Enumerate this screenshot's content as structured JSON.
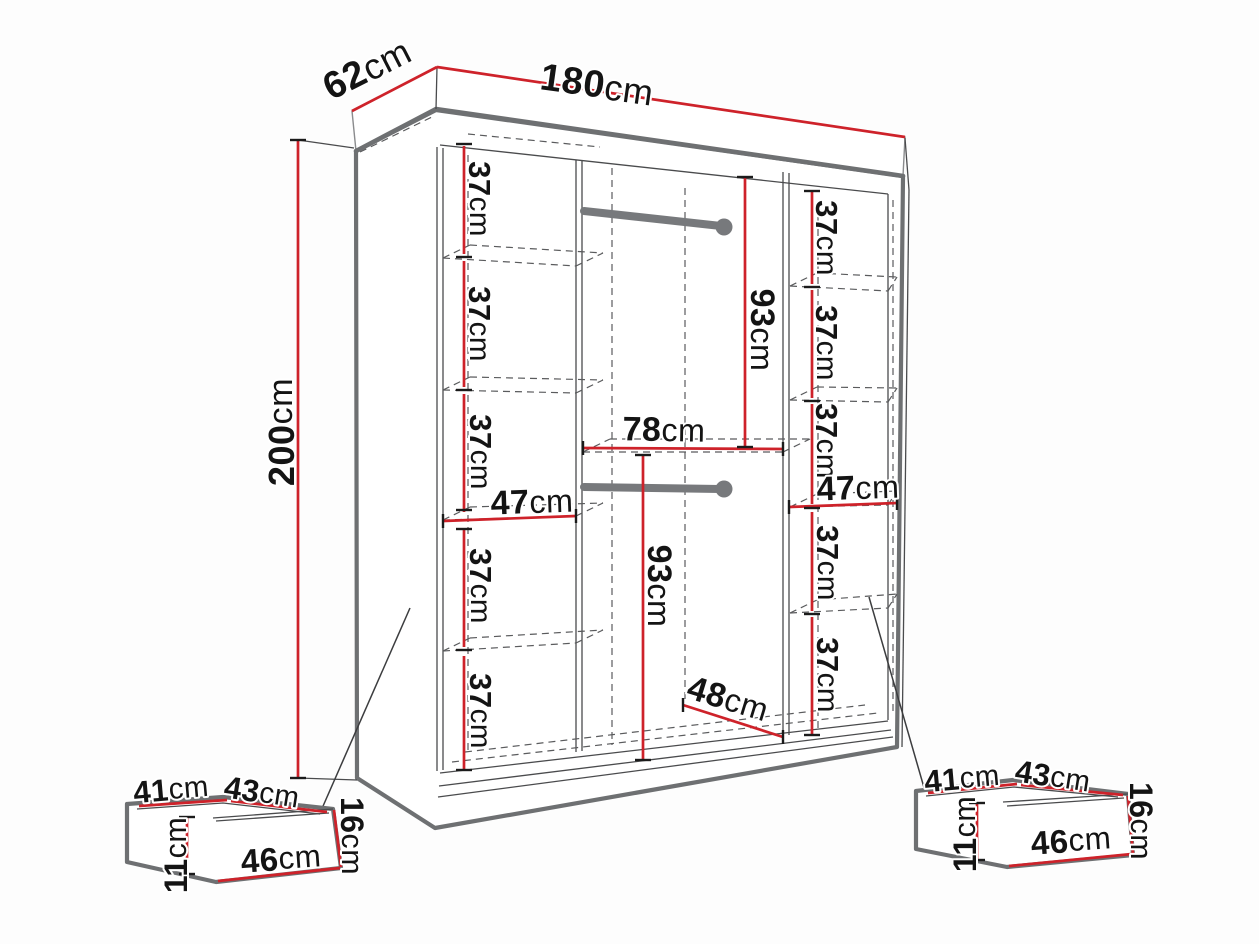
{
  "diagram": {
    "type": "furniture-dimension-diagram",
    "subject": "wardrobe-with-shelves-rails-and-two-drawers",
    "unit": "cm",
    "overall": {
      "width": "180",
      "depth": "62",
      "height": "200"
    },
    "colors": {
      "dimension_red": "#ce222a",
      "outline_gray": "#6e7072",
      "line_dark": "#3c3d3f",
      "dash_gray": "#5a5b5d",
      "rail_gray": "#77797c",
      "text": "#141414",
      "background": "#fdfdfd"
    },
    "labels": [
      {
        "id": "depth-62",
        "value": "62",
        "unit": "cm",
        "x": 367,
        "y": 69,
        "rot": -27,
        "size": 38
      },
      {
        "id": "width-180",
        "value": "180",
        "unit": "cm",
        "x": 597,
        "y": 85,
        "rot": 8,
        "size": 38
      },
      {
        "id": "height-200",
        "value": "200",
        "unit": "cm",
        "x": 281,
        "y": 432,
        "rot": -90,
        "size": 36
      },
      {
        "id": "shelf-37-left-1",
        "value": "37",
        "unit": "cm",
        "x": 480,
        "y": 199,
        "rot": 90,
        "size": 31
      },
      {
        "id": "shelf-37-left-2",
        "value": "37",
        "unit": "cm",
        "x": 480,
        "y": 324,
        "rot": 90,
        "size": 31
      },
      {
        "id": "shelf-37-left-3",
        "value": "37",
        "unit": "cm",
        "x": 481,
        "y": 452,
        "rot": 90,
        "size": 31
      },
      {
        "id": "shelf-37-left-4",
        "value": "37",
        "unit": "cm",
        "x": 481,
        "y": 586,
        "rot": 90,
        "size": 31
      },
      {
        "id": "shelf-37-left-5",
        "value": "37",
        "unit": "cm",
        "x": 481,
        "y": 711,
        "rot": 90,
        "size": 31
      },
      {
        "id": "width-47-left",
        "value": "47",
        "unit": "cm",
        "x": 532,
        "y": 502,
        "rot": -2,
        "size": 34
      },
      {
        "id": "height-93-top",
        "value": "93",
        "unit": "cm",
        "x": 762,
        "y": 330,
        "rot": 90,
        "size": 34
      },
      {
        "id": "width-78",
        "value": "78",
        "unit": "cm",
        "x": 664,
        "y": 430,
        "rot": 1,
        "size": 34
      },
      {
        "id": "height-93-bottom",
        "value": "93",
        "unit": "cm",
        "x": 659,
        "y": 586,
        "rot": 90,
        "size": 34
      },
      {
        "id": "width-48",
        "value": "48",
        "unit": "cm",
        "x": 728,
        "y": 699,
        "rot": 17,
        "size": 34
      },
      {
        "id": "shelf-37-right-1",
        "value": "37",
        "unit": "cm",
        "x": 827,
        "y": 238,
        "rot": 90,
        "size": 31
      },
      {
        "id": "shelf-37-right-2",
        "value": "37",
        "unit": "cm",
        "x": 827,
        "y": 343,
        "rot": 90,
        "size": 31
      },
      {
        "id": "shelf-37-right-3",
        "value": "37",
        "unit": "cm",
        "x": 827,
        "y": 441,
        "rot": 90,
        "size": 31
      },
      {
        "id": "width-47-right",
        "value": "47",
        "unit": "cm",
        "x": 858,
        "y": 488,
        "rot": -2,
        "size": 34
      },
      {
        "id": "shelf-37-right-4",
        "value": "37",
        "unit": "cm",
        "x": 828,
        "y": 563,
        "rot": 90,
        "size": 31
      },
      {
        "id": "shelf-37-right-5",
        "value": "37",
        "unit": "cm",
        "x": 828,
        "y": 675,
        "rot": 90,
        "size": 31
      },
      {
        "id": "drawer-left-41",
        "value": "41",
        "unit": "cm",
        "x": 171,
        "y": 789,
        "rot": -5,
        "size": 31
      },
      {
        "id": "drawer-left-43",
        "value": "43",
        "unit": "cm",
        "x": 262,
        "y": 792,
        "rot": 9,
        "size": 31
      },
      {
        "id": "drawer-left-11",
        "value": "11",
        "unit": "cm",
        "x": 176,
        "y": 855,
        "rot": -90,
        "size": 32
      },
      {
        "id": "drawer-left-46",
        "value": "46",
        "unit": "cm",
        "x": 281,
        "y": 858,
        "rot": -4,
        "size": 33
      },
      {
        "id": "drawer-left-16",
        "value": "16",
        "unit": "cm",
        "x": 352,
        "y": 836,
        "rot": 90,
        "size": 32
      },
      {
        "id": "drawer-right-41",
        "value": "41",
        "unit": "cm",
        "x": 962,
        "y": 778,
        "rot": -5,
        "size": 31
      },
      {
        "id": "drawer-right-43",
        "value": "43",
        "unit": "cm",
        "x": 1053,
        "y": 776,
        "rot": 9,
        "size": 31
      },
      {
        "id": "drawer-right-11",
        "value": "11",
        "unit": "cm",
        "x": 965,
        "y": 834,
        "rot": -90,
        "size": 32
      },
      {
        "id": "drawer-right-46",
        "value": "46",
        "unit": "cm",
        "x": 1071,
        "y": 840,
        "rot": -4,
        "size": 33
      },
      {
        "id": "drawer-right-16",
        "value": "16",
        "unit": "cm",
        "x": 1141,
        "y": 821,
        "rot": 90,
        "size": 32
      }
    ]
  }
}
